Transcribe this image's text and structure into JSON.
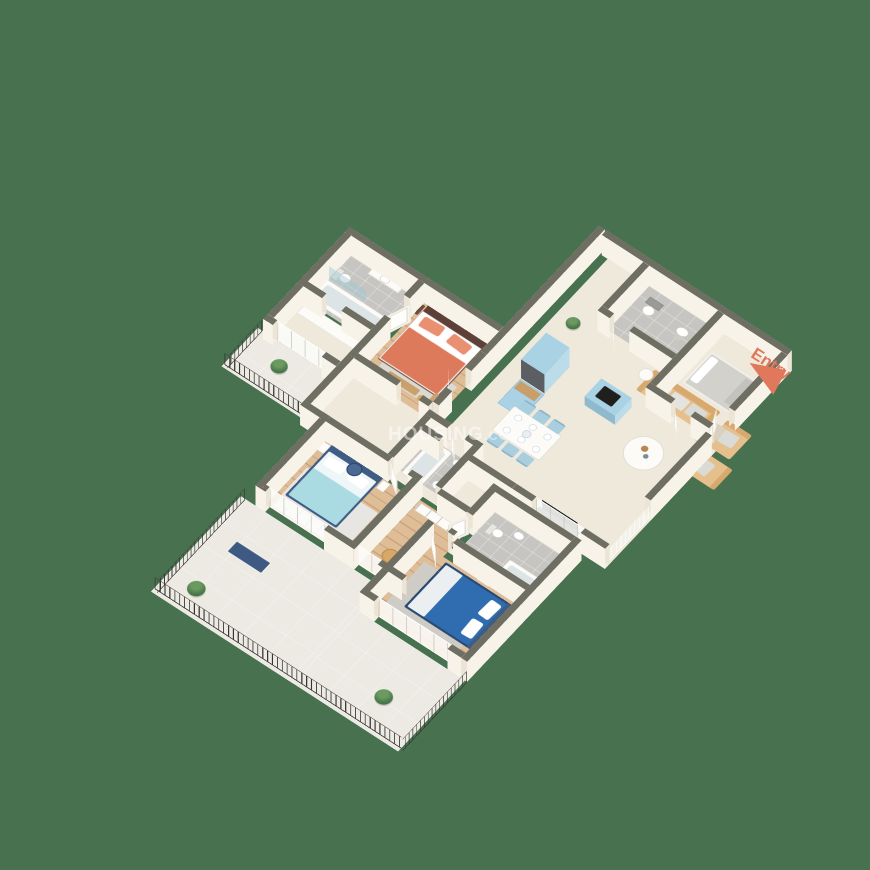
{
  "scene": {
    "type": "isometric 3D floor plan render of a 3-bedroom apartment",
    "background_is_plain": true
  },
  "labels": {
    "entry": "Entry"
  },
  "watermark": {
    "text_main": "HOUSING",
    "text_suffix": ".COM"
  },
  "colors": {
    "background": "#47714f",
    "wall_cap": "#6e6e62",
    "wall_face": "#f8f3e9",
    "wall_face_shade": "#ece5d6",
    "wood": "#dfbd97",
    "tile": "#c6c5c1",
    "cream": "#efe9dc",
    "balcony": "#eceae3",
    "accent_coral": "#e0795b",
    "master_bed": "#dd7a5c",
    "master_pillow": "#e98f72",
    "bed2": "#aadbe3",
    "bed2_frame": "#3f5c85",
    "bed3": "#2f6cb0",
    "sofa": "#e6c08c",
    "sofa_back": "#d7a96f",
    "kitchen_cabinet": "#a9d2e4",
    "appliance": "#5b5e63",
    "dining_chair": "#a9cfdf",
    "rail_dark": "#35342f",
    "navy_bench": "#3e5a82",
    "plant_green": "#4c7a4c",
    "watermark": "rgba(255,255,255,0.5)"
  },
  "rooms": [
    {
      "name": "master-bedroom",
      "furniture": [
        "double bed with coral bedding",
        "two nightstands",
        "rug",
        "bench",
        "desk and stool"
      ]
    },
    {
      "name": "master-bathroom",
      "furniture": [
        "toilet",
        "washbasin counter",
        "bathtub",
        "glass shower screen"
      ]
    },
    {
      "name": "dressing-area",
      "furniture": [
        "wardrobe"
      ]
    },
    {
      "name": "master-balcony",
      "furniture": [
        "potted plant",
        "metal railing"
      ]
    },
    {
      "name": "kitchen",
      "furniture": [
        "tall fridge unit",
        "blue base cabinet",
        "cooktop counter",
        "potted plant"
      ]
    },
    {
      "name": "dining-area",
      "furniture": [
        "dining table",
        "six blue chairs",
        "place settings"
      ]
    },
    {
      "name": "common-bathroom",
      "furniture": [
        "bathtub",
        "washbasin",
        "toilet"
      ]
    },
    {
      "name": "living-room",
      "furniture": [
        "three-seat sofa",
        "two armchairs",
        "round coffee table",
        "side table",
        "TV unit",
        "doormat"
      ]
    },
    {
      "name": "foyer-room",
      "furniture": [
        "single bed with grey bedding"
      ]
    },
    {
      "name": "toilet-top-right",
      "furniture": [
        "toilet",
        "washbasin"
      ]
    },
    {
      "name": "bedroom-2",
      "furniture": [
        "double bed with light blue bedding",
        "round mirror",
        "dresser",
        "wardrobe",
        "TV unit"
      ]
    },
    {
      "name": "bedroom-3",
      "furniture": [
        "double bed with dark blue bedding",
        "nightstand",
        "rug"
      ]
    },
    {
      "name": "bathroom-2",
      "furniture": [
        "washbasin",
        "toilet",
        "bathtub",
        "dark glass shower screen"
      ]
    },
    {
      "name": "hall-passage",
      "furniture": [
        "wardrobe",
        "two tan stools"
      ]
    },
    {
      "name": "lower-balcony",
      "furniture": [
        "navy bench",
        "two potted plants",
        "metal railing"
      ]
    },
    {
      "name": "living-side-railing",
      "furniture": [
        "white glass railing"
      ]
    }
  ]
}
